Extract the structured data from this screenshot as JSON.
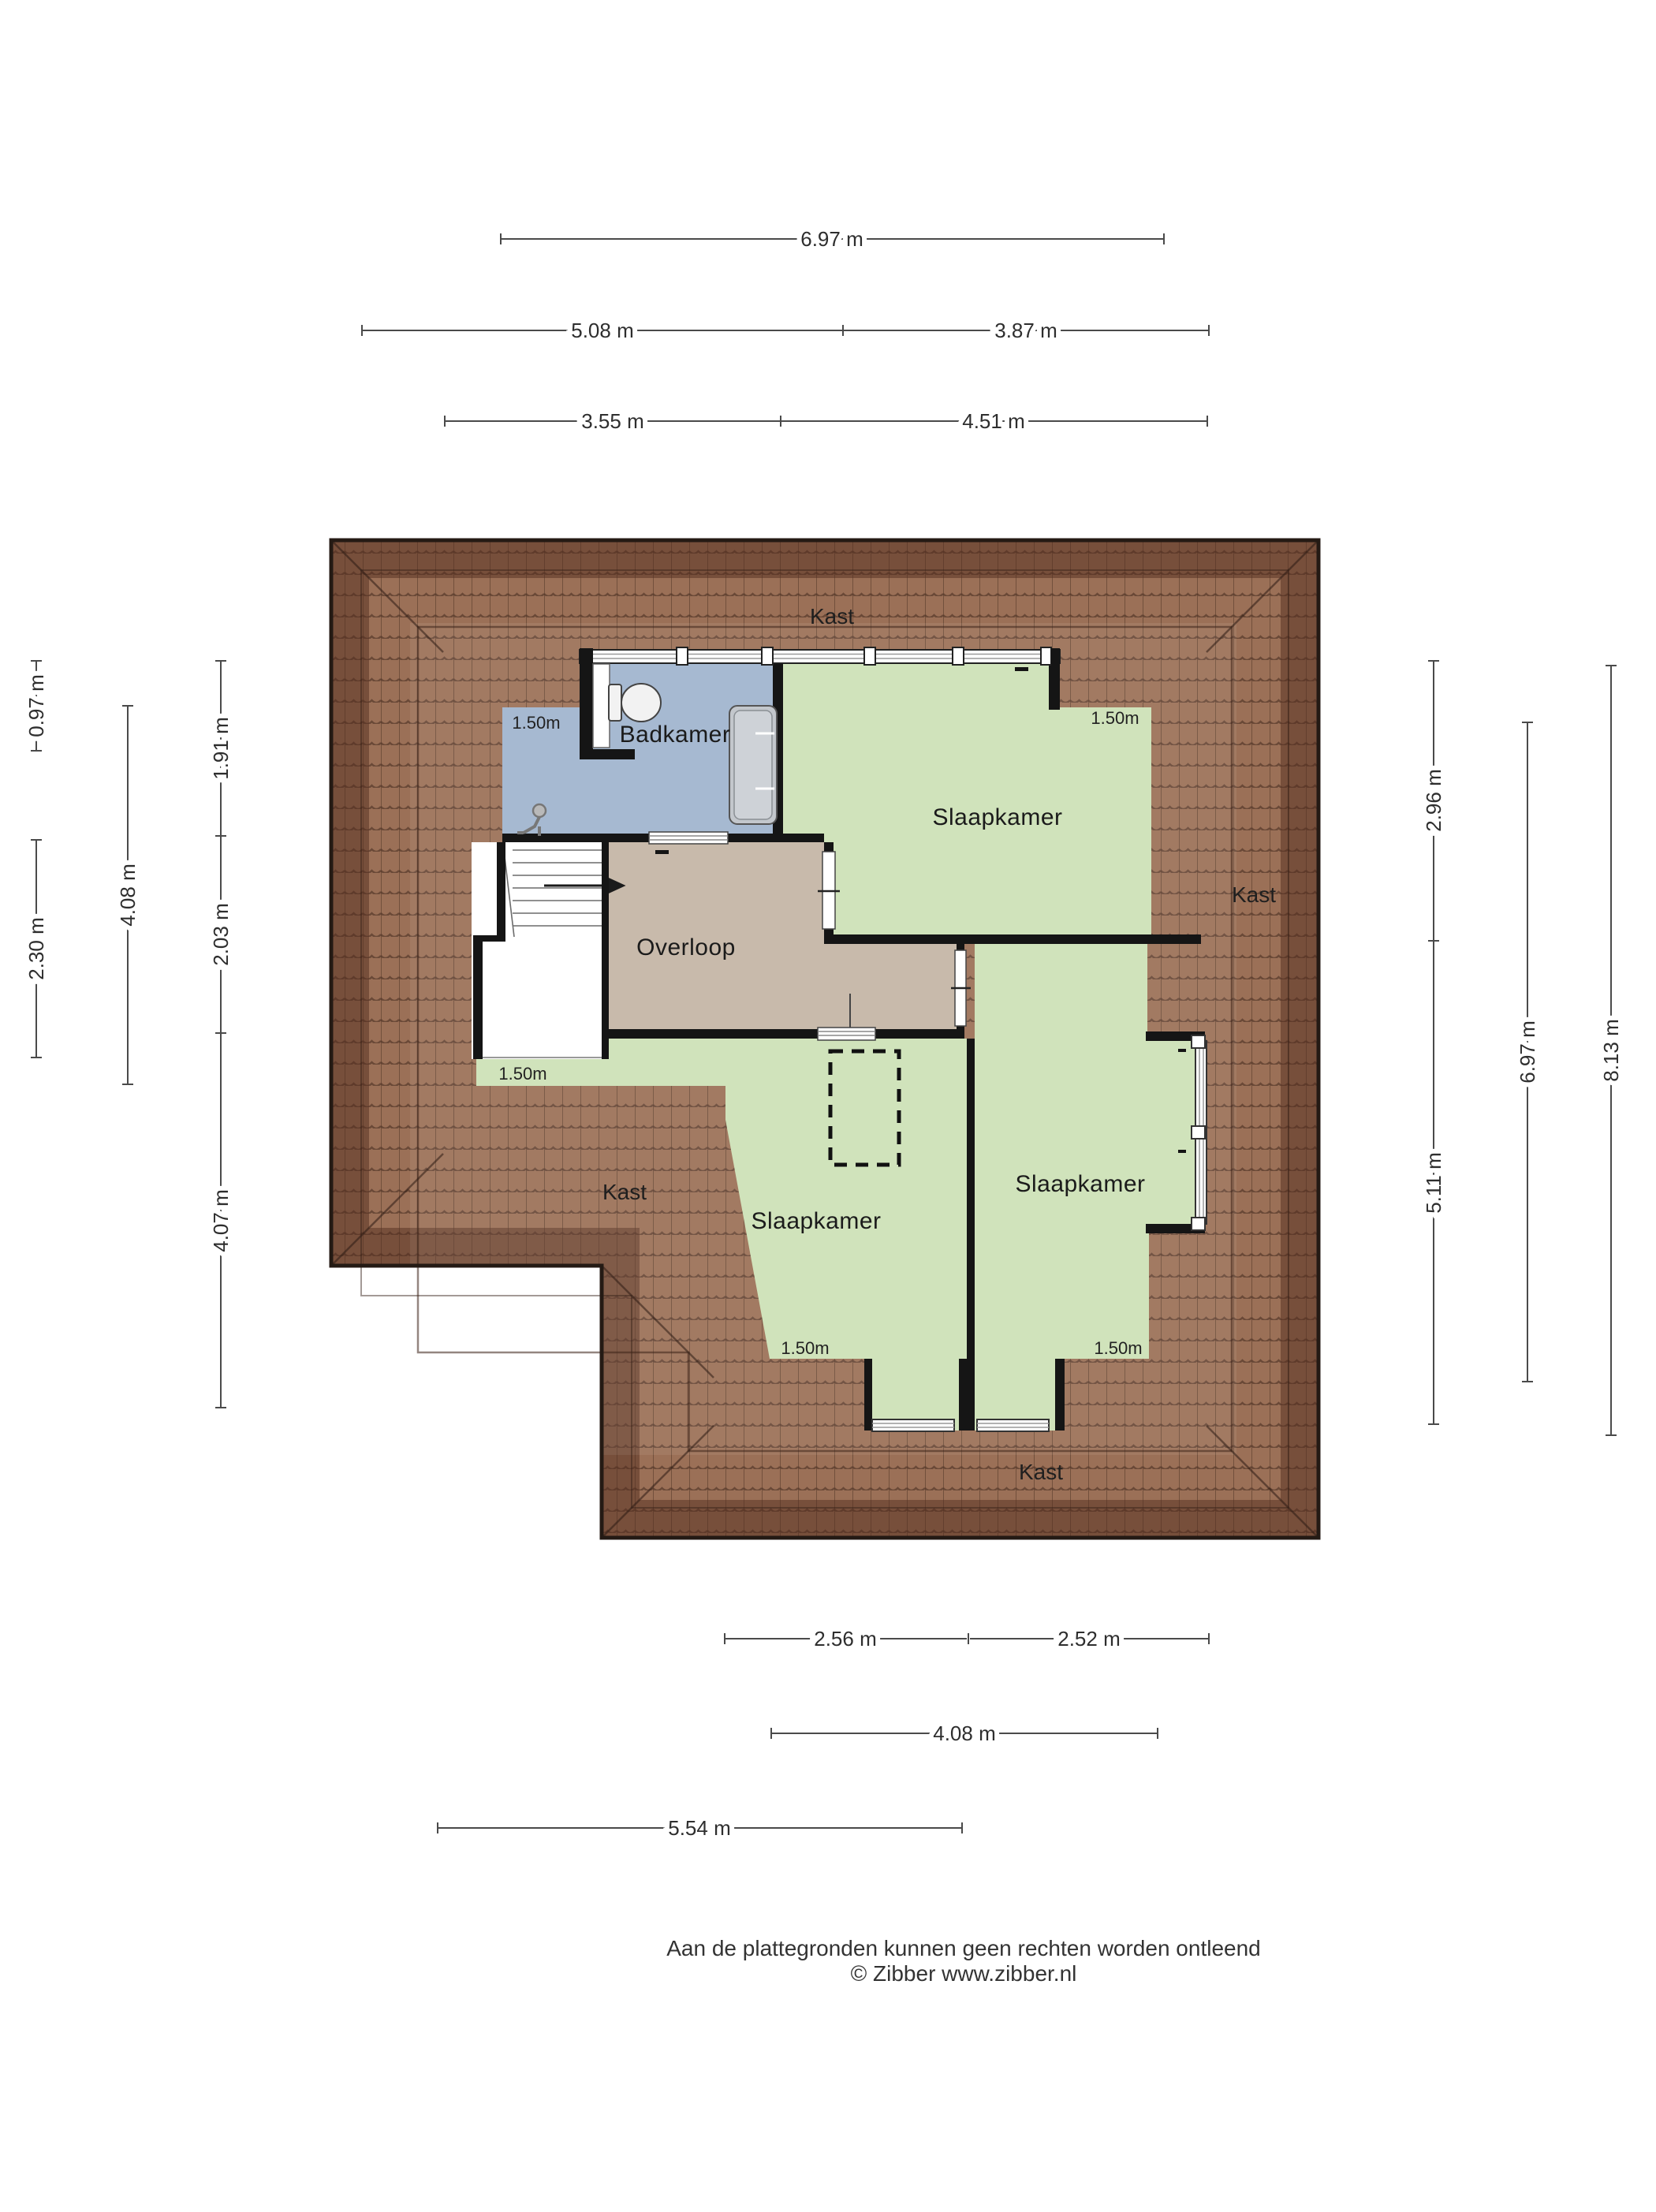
{
  "floorplan": {
    "room_labels": {
      "kast_top": "Kast",
      "kast_left": "Kast",
      "kast_right": "Kast",
      "kast_bottom": "Kast",
      "badkamer": "Badkamer",
      "overloop": "Overloop",
      "slaapkamer_top": "Slaapkamer",
      "slaapkamer_middle": "Slaapkamer",
      "slaapkamer_right": "Slaapkamer"
    },
    "height_marker": "1.50m",
    "colors": {
      "bedroom_green": "#d0e3bb",
      "bathroom_blue": "#a6b9d1",
      "hallway_tan": "#c8baab",
      "roof_brown": "#9b7057",
      "roof_line": "#503526",
      "wall_black": "#151515"
    }
  },
  "dimensions": {
    "top": [
      "6.97 m",
      "5.08 m",
      "3.87 m",
      "3.55 m",
      "4.51 m"
    ],
    "left": [
      "0.97 m",
      "2.30 m",
      "4.08 m",
      "1.91 m",
      "2.03 m",
      "4.07 m"
    ],
    "right": [
      "2.96 m",
      "5.11 m",
      "6.97 m",
      "8.13 m"
    ],
    "bottom": [
      "2.56 m",
      "2.52 m",
      "4.08 m",
      "5.54 m"
    ]
  },
  "footer": {
    "line1": "Aan de plattegronden kunnen geen rechten worden ontleend",
    "line2": "© Zibber www.zibber.nl"
  }
}
